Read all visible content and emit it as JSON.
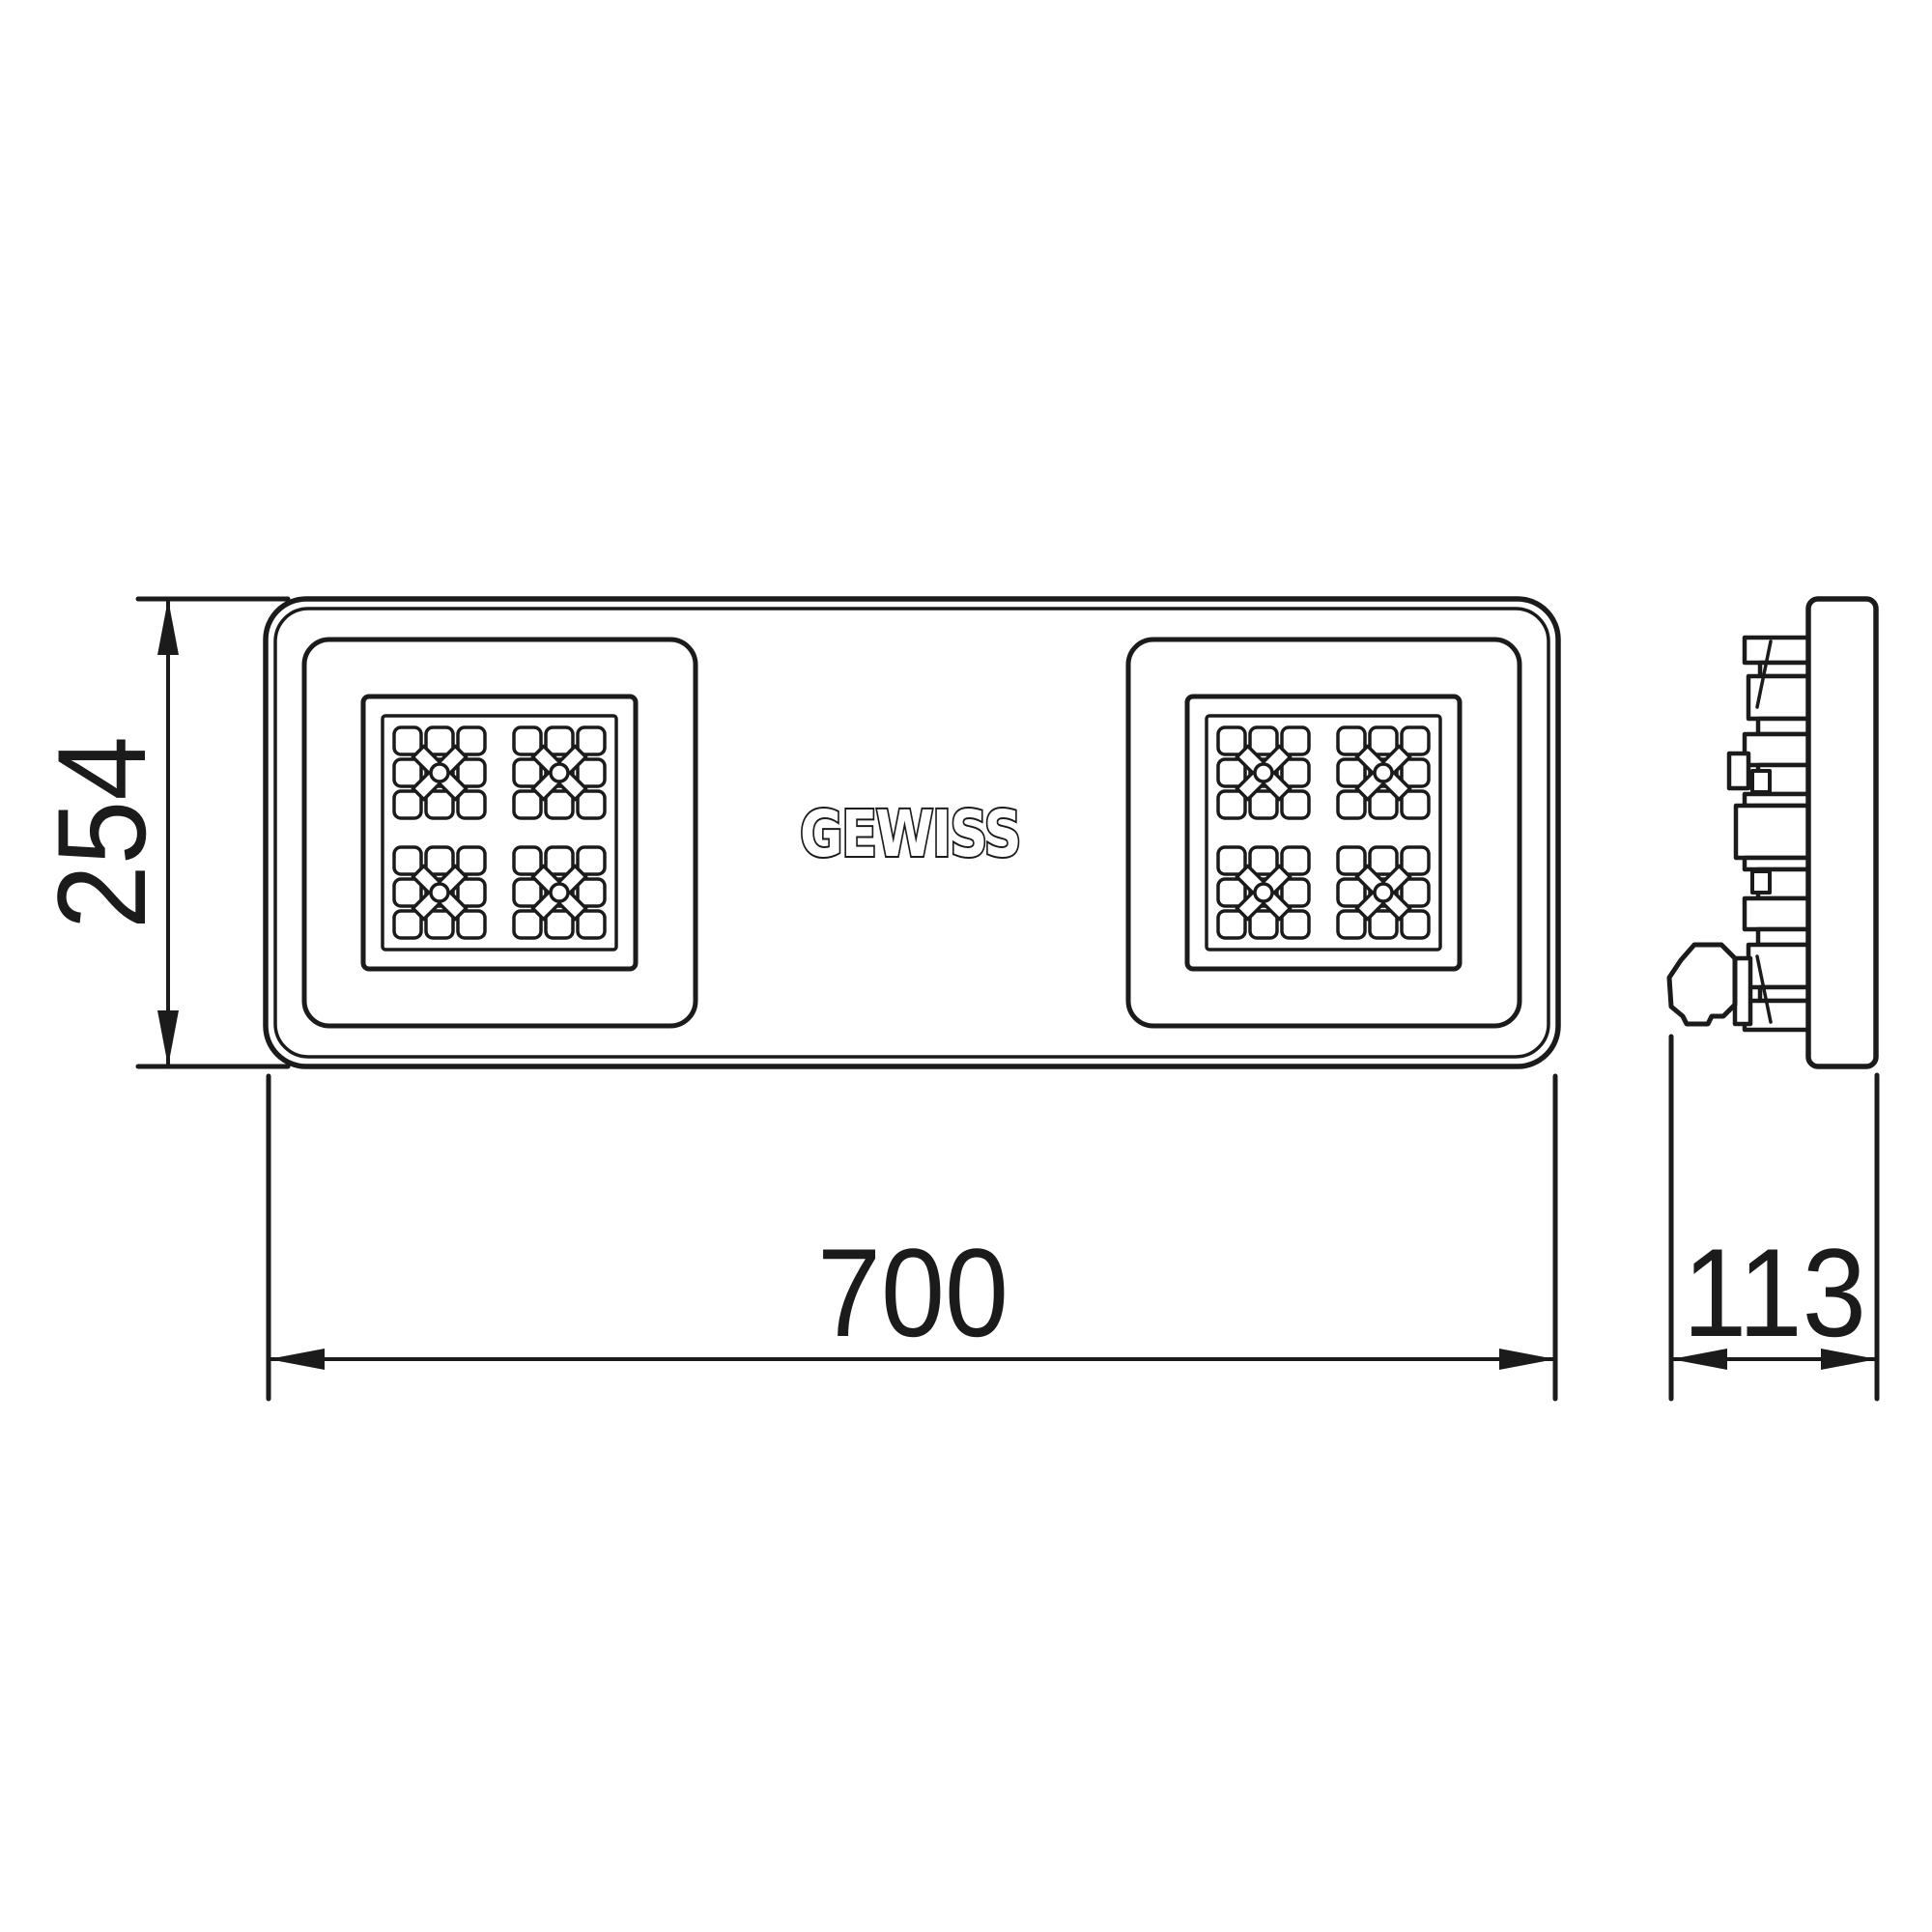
{
  "drawing": {
    "brand_logo": "GEWISS",
    "dimensions": {
      "height": "254",
      "width": "700",
      "depth": "113"
    }
  },
  "style": {
    "line_color": "#1b1b1b",
    "background_color": "#ffffff"
  }
}
